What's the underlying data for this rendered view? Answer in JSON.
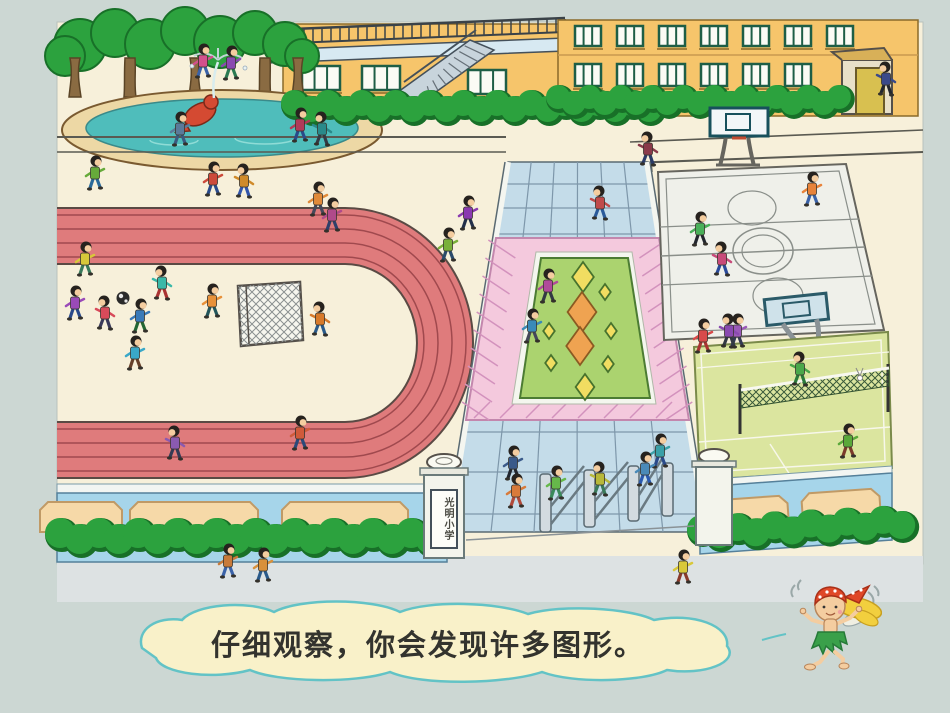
{
  "scene": {
    "background_color": "#ccd7d3",
    "ground_color": "#f7f0da",
    "sidewalk_color": "#dde2e3",
    "speech_bubble": {
      "text": "仔细观察，你会发现许多图形。",
      "fill": "#f9f1c9",
      "border_color": "#63c3c6",
      "text_color": "#33332e"
    },
    "school_sign": {
      "text": "光明小学"
    },
    "palette": {
      "track": "#df7b7c",
      "track_line": "#a0494e",
      "track_edge": "#5a4a44",
      "walkway_tile": "#c4dce9",
      "walkway_grid": "#7e97aa",
      "flowerbed_pink": "#f4c9dd",
      "flowerbed_stripe": "#d392bd",
      "flowerbed_green": "#abd36f",
      "diamond_yellow": "#f1dd61",
      "diamond_orange": "#efa351",
      "building": "#f6c56b",
      "window_frame": "#1e5e46",
      "bush": "#2ca23e",
      "bush_dark": "#187028",
      "trunk": "#8a6b42",
      "water": "#4fbdbb",
      "pool_rim": "#edd8a5",
      "fish_red": "#d44a32",
      "wall_blue": "#a6d5ea",
      "wall_panel": "#f6d9a8",
      "bball_court": "#eff0ea",
      "badminton_green": "#dbe59f",
      "skin": "#f4cda0",
      "hair": "#26221e",
      "fairy_bandana": "#e04828",
      "fairy_hair": "#f2cf3e",
      "fairy_skirt": "#3aa04a"
    },
    "children": [
      [
        203,
        62,
        "#d2508c",
        "#3a62a8",
        1
      ],
      [
        231,
        64,
        "#8a4ab0",
        "#2a7a52",
        1
      ],
      [
        180,
        130,
        "#5a7a9a",
        "#3a5a80",
        1
      ],
      [
        300,
        126,
        "#b03a5a",
        "#2a4a8a",
        1
      ],
      [
        322,
        130,
        "#2a8a8a",
        "#333a44",
        -1
      ],
      [
        886,
        80,
        "#3a4a8a",
        "#22262e",
        -1
      ],
      [
        95,
        174,
        "#66aa3a",
        "#2a6a9a",
        1
      ],
      [
        213,
        180,
        "#cc4a3a",
        "#2a4a8a",
        1
      ],
      [
        244,
        182,
        "#d08a2a",
        "#3355aa",
        -1
      ],
      [
        318,
        200,
        "#e08a3a",
        "#44485a",
        1
      ],
      [
        468,
        214,
        "#8a3ab0",
        "#23304a",
        1
      ],
      [
        600,
        204,
        "#c04a4a",
        "#2a5a9a",
        -1
      ],
      [
        448,
        246,
        "#7ab03a",
        "#2a4a6a",
        1
      ],
      [
        332,
        216,
        "#b04a8a",
        "#30406a",
        1
      ],
      [
        300,
        434,
        "#d05a3a",
        "#2a4a7a",
        1
      ],
      [
        175,
        444,
        "#8a5ab0",
        "#333a55",
        -1
      ],
      [
        513,
        464,
        "#3a5a8a",
        "#22262e",
        1
      ],
      [
        85,
        260,
        "#d8c83a",
        "#3a7a5a",
        1
      ],
      [
        75,
        304,
        "#9a4ab8",
        "#2a4a8a",
        1
      ],
      [
        105,
        314,
        "#d84a5a",
        "#3a3a5a",
        -1
      ],
      [
        140,
        317,
        "#3a7ab8",
        "#226633",
        1
      ],
      [
        162,
        284,
        "#3ab8a8",
        "#aa3333",
        -1
      ],
      [
        212,
        302,
        "#e8913a",
        "#22555a",
        1
      ],
      [
        135,
        354,
        "#3aa8c8",
        "#66402a",
        1
      ],
      [
        320,
        320,
        "#d87a2a",
        "#2a5a8a",
        -1
      ],
      [
        548,
        287,
        "#b04a9a",
        "#333a44",
        1
      ],
      [
        532,
        327,
        "#3a8ab8",
        "#44485a",
        1
      ],
      [
        700,
        230,
        "#4ab05a",
        "#22262e",
        1
      ],
      [
        722,
        260,
        "#c84a7a",
        "#2a4a9a",
        -1
      ],
      [
        812,
        190,
        "#e8833a",
        "#3a62a8",
        1
      ],
      [
        737,
        332,
        "#9a5ab8",
        "#333a55",
        1
      ],
      [
        648,
        150,
        "#8a3a4a",
        "#2a3a66",
        -1
      ],
      [
        703,
        337,
        "#d84a4a",
        "#aa3333",
        1
      ],
      [
        729,
        332,
        "#8a4ab0",
        "#333a44",
        -1
      ],
      [
        660,
        452,
        "#3aa0a8",
        "#2a4a8a",
        1
      ],
      [
        800,
        370,
        "#4aa84a",
        "#2a7a3a",
        -1
      ],
      [
        848,
        442,
        "#5aa83a",
        "#7a3a2a",
        1
      ],
      [
        516,
        492,
        "#d87a3a",
        "#b04a3a",
        1
      ],
      [
        556,
        484,
        "#66b84a",
        "#3a8a5a",
        1
      ],
      [
        600,
        480,
        "#b8b83a",
        "#3a7a5a",
        -1
      ],
      [
        645,
        470,
        "#4a8ab8",
        "#2a5ab0",
        1
      ],
      [
        228,
        562,
        "#c87a3a",
        "#3a62a8",
        1
      ],
      [
        263,
        566,
        "#d8903a",
        "#2a5a8a",
        1
      ],
      [
        683,
        568,
        "#d8c83a",
        "#8a3a2a",
        1
      ]
    ],
    "diamonds": [
      [
        583,
        277,
        15,
        "y"
      ],
      [
        605,
        292,
        8,
        "y"
      ],
      [
        582,
        312,
        20,
        "o"
      ],
      [
        580,
        346,
        19,
        "o"
      ],
      [
        549,
        331,
        8,
        "y"
      ],
      [
        611,
        331,
        8,
        "y"
      ],
      [
        551,
        363,
        8,
        "y"
      ],
      [
        608,
        364,
        8,
        "y"
      ],
      [
        585,
        387,
        13,
        "y"
      ]
    ]
  }
}
